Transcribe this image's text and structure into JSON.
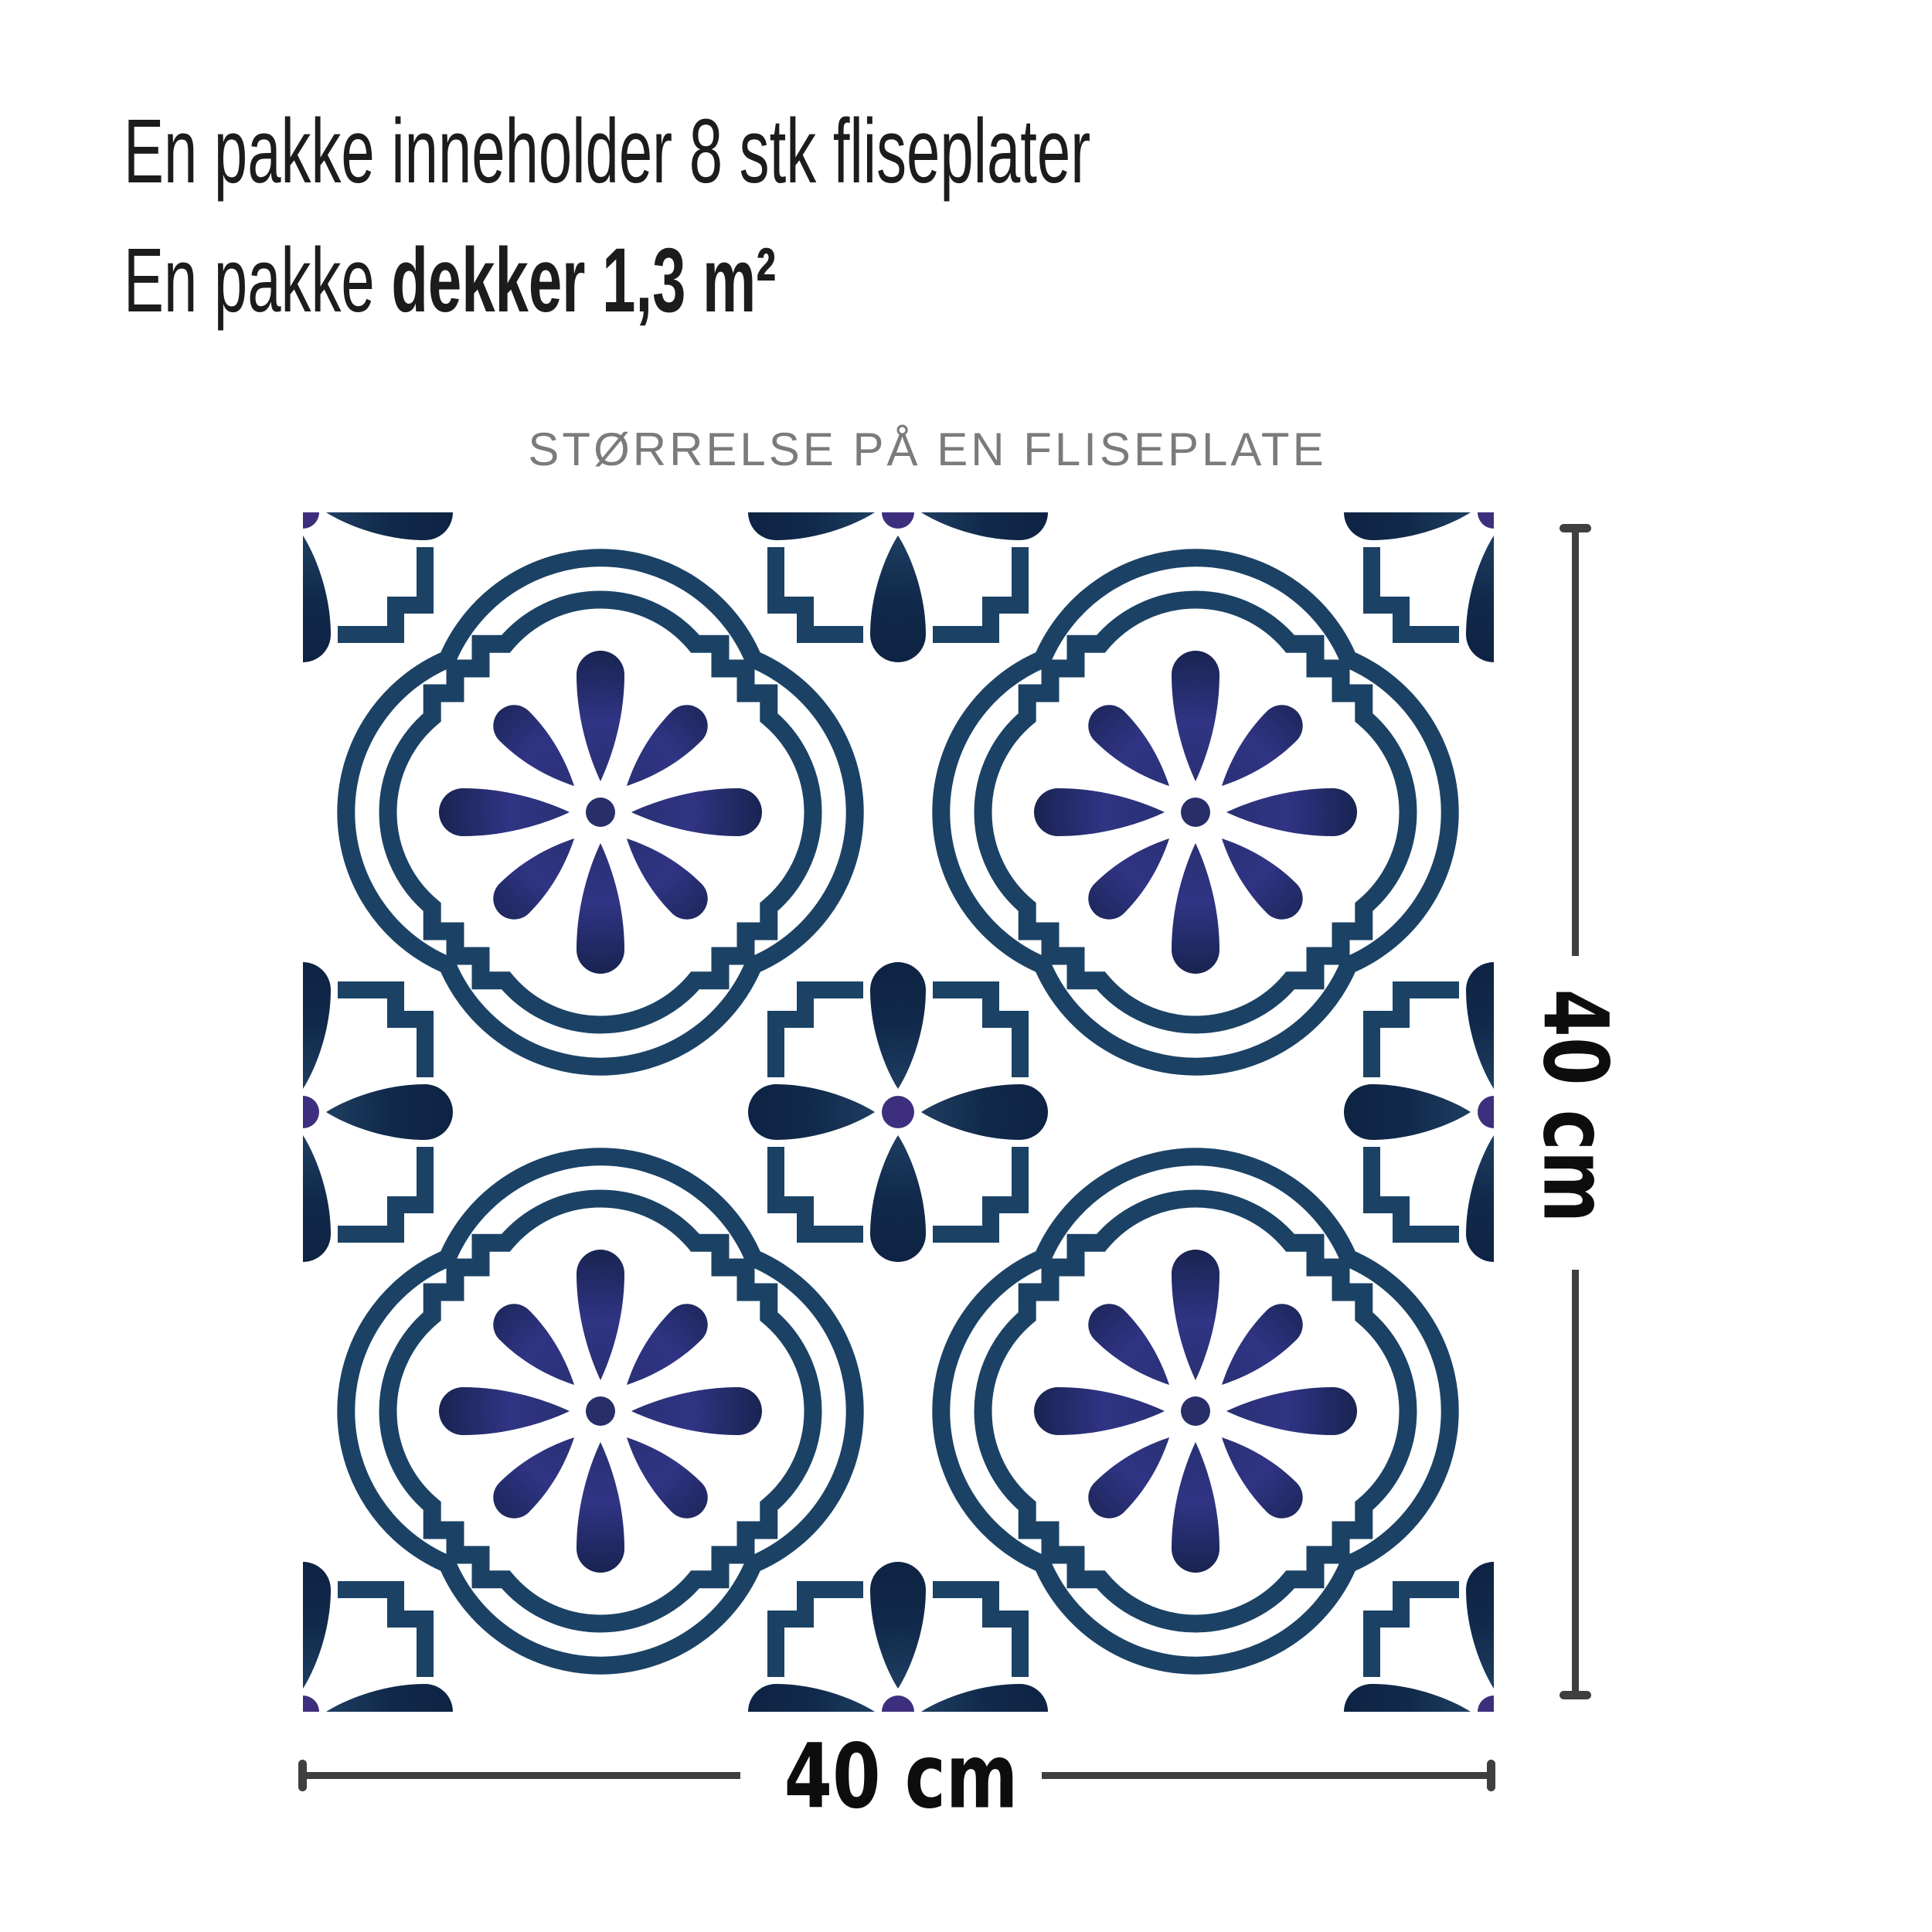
{
  "title": {
    "line1": "En pakke inneholder 8 stk fliseplater",
    "line2_prefix": "En pakke ",
    "line2_bold": "dekker 1,3 m²"
  },
  "tile_figure": {
    "caption": "STØRRELSE PÅ EN FLISEPLATE",
    "width_label": "40 cm",
    "height_label": "40 cm"
  },
  "colors": {
    "pattern_outline_teal_navy": "#1b4265",
    "flower_indigo": "#2e3282",
    "cross_petal_navy": "#13294b",
    "cross_dot_purple": "#3e2f7e",
    "dimension_line_gray": "#3f3f3f",
    "title_text": "#1c1c1c",
    "caption_gray": "#7b7b7b",
    "background": "#ffffff"
  }
}
